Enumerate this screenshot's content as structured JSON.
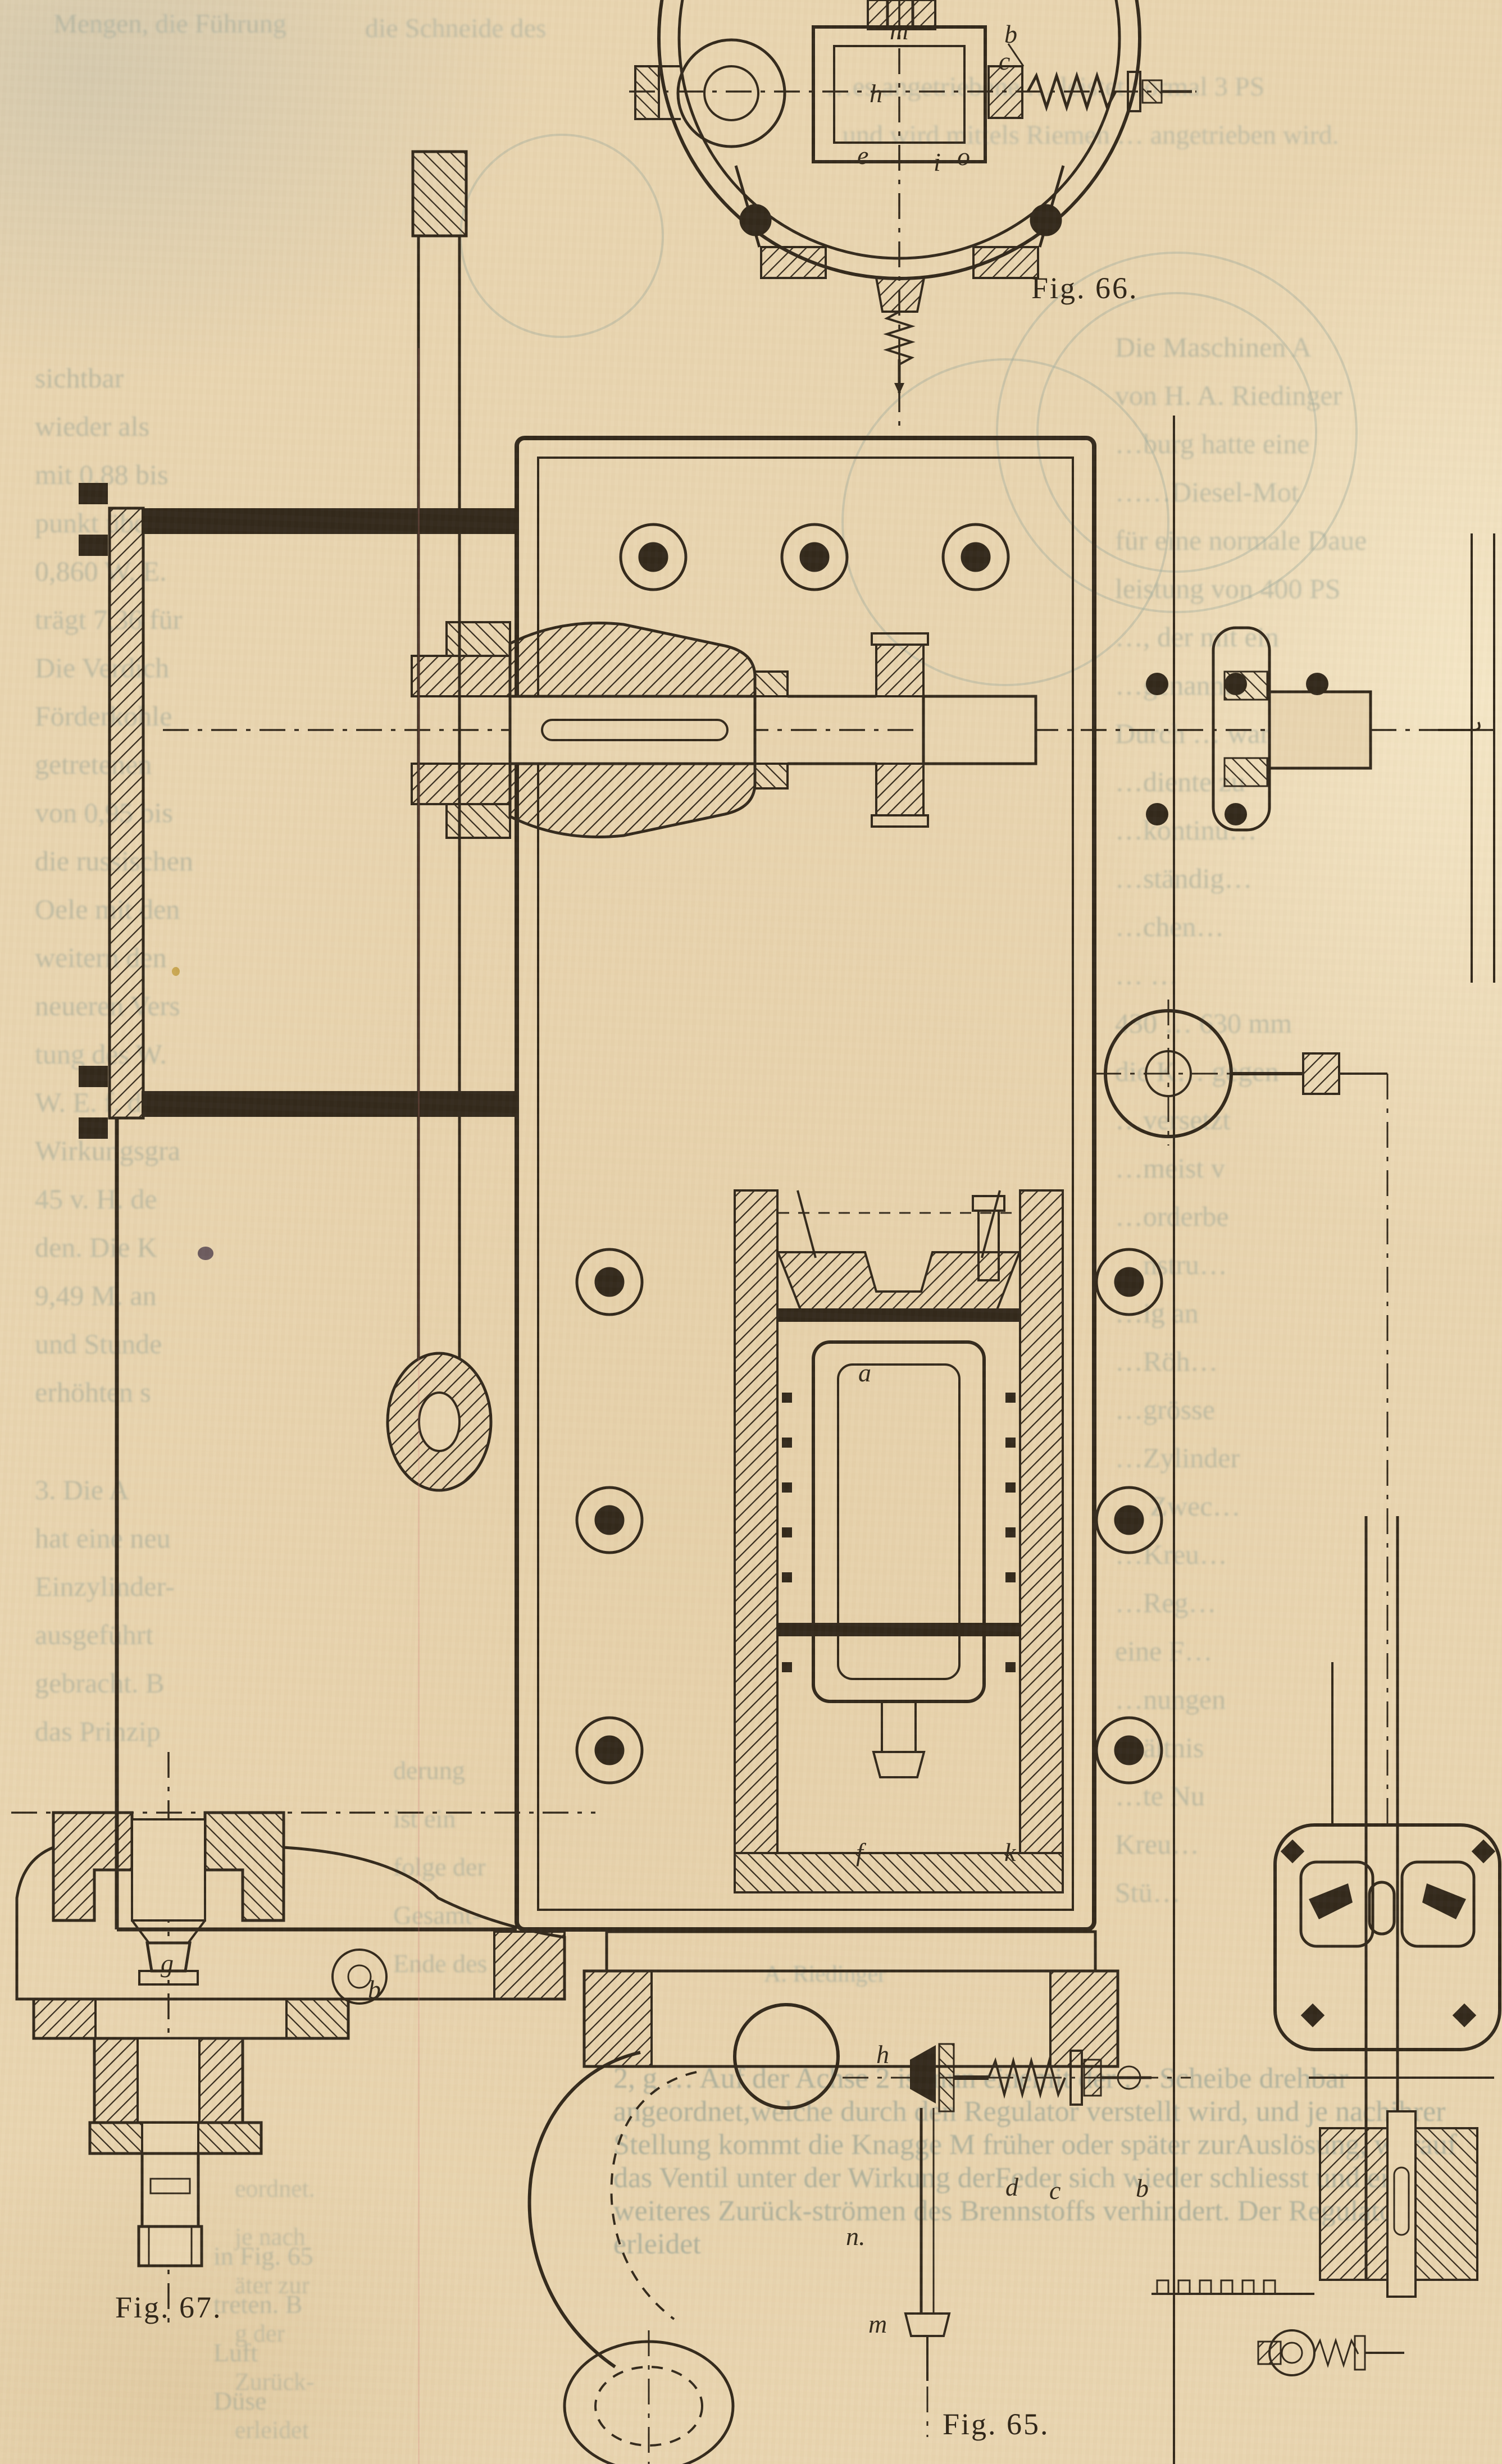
{
  "page": {
    "type": "scanned book page, German engineering text with machine cross-section figures",
    "paper_color": "#e9d5b0",
    "ink_color": "#32281b",
    "ghost_text_color": "#86988f"
  },
  "captions": {
    "fig66": "Fig. 66.",
    "fig65": "Fig. 65.",
    "fig67": "Fig. 67."
  },
  "labels": {
    "fig66": [
      "m",
      "b",
      "c",
      "h",
      "e",
      "i",
      "o"
    ],
    "fig65": [
      "a",
      "f",
      "k",
      "h",
      "d",
      "c",
      "b",
      "n.",
      "m"
    ],
    "fig67": [
      "g",
      "b"
    ]
  },
  "ghost": {
    "top": [
      "Mengen, die Führung",
      "die Schneide des",
      "…es angetriebene … leistet normal 3 PS",
      "und wird mittels Riemen … angetrieben wird."
    ],
    "left_column": [
      "sichtbar",
      "wieder als",
      "mit 0,88 bis",
      "punkt über 1",
      "0,860 W. E.",
      "trägt 7,36 für",
      "Die Verdich",
      "Förderkohle",
      "getretenen",
      "von 0,95 bis",
      "die russischen",
      "Oele mit den",
      "weitern den",
      "neueren Vers",
      "tung des W.",
      "W. E. f. d. P",
      "Wirkungsgra",
      "45 v. H. de",
      "den. Die K",
      "9,49 M. an",
      "und Stunde",
      "erhöhten s"
    ],
    "left_column_2": [
      "3. Die A",
      "hat eine neu",
      "Einzylinder-",
      "ausgeführt",
      "gebracht. B",
      "das Prinzip"
    ],
    "left_mid_fragments": [
      "derung",
      "ist ein",
      "folge der",
      "Gesamt-",
      "Ende des"
    ],
    "left_lower_fragments": [
      "in Fig. 65",
      "treten. B",
      "Luft",
      "Düse"
    ],
    "left_edge_fragments": [
      "eordnet.",
      "je nach",
      "äter zur",
      "g der",
      "Zurück-",
      "erleidet"
    ],
    "right_column": [
      "Die Maschinen A",
      "von H. A. Riedinger",
      "…burg hatte eine",
      "……Diesel-Mot",
      "für eine normale Daue",
      "leistung von 400 PS",
      "…, der mit ein",
      "…genannte",
      "Durch … war De",
      "…diente zu",
      "…kontinu…",
      "…ständig…",
      "…chen…",
      "… …",
      "430 … 630 mm",
      "die K… gegen",
      "…versetzt",
      "…meist v",
      "…orderbe",
      "…nstru…",
      "…ig an",
      "…Röh…",
      "…grösse",
      "…Zylinder",
      "… Zwec…",
      "…Kreu…",
      "…Reg…",
      "eine F…",
      "…nungen",
      "…ältnis",
      "…te Nu",
      "Kreu…",
      "Stü…"
    ],
    "bottom_paragraph": [
      "2, g … Auf der Achse 2 ist nun eine",
      "mit der … Scheibe drehbar angeordnet,",
      "welche durch den Regulator verstellt wird, und je nach",
      "ihrer Stellung kommt die Knagge M früher oder später zur",
      "Auslösung, worauf das Ventil unter der Wirkung der",
      "Feder sich wieder schliesst und ein weiteres Zurück-",
      "strömen des Brennstoffs verhindert. Der Regulator erleidet"
    ],
    "caption_fragment": "A. Riedinger"
  }
}
